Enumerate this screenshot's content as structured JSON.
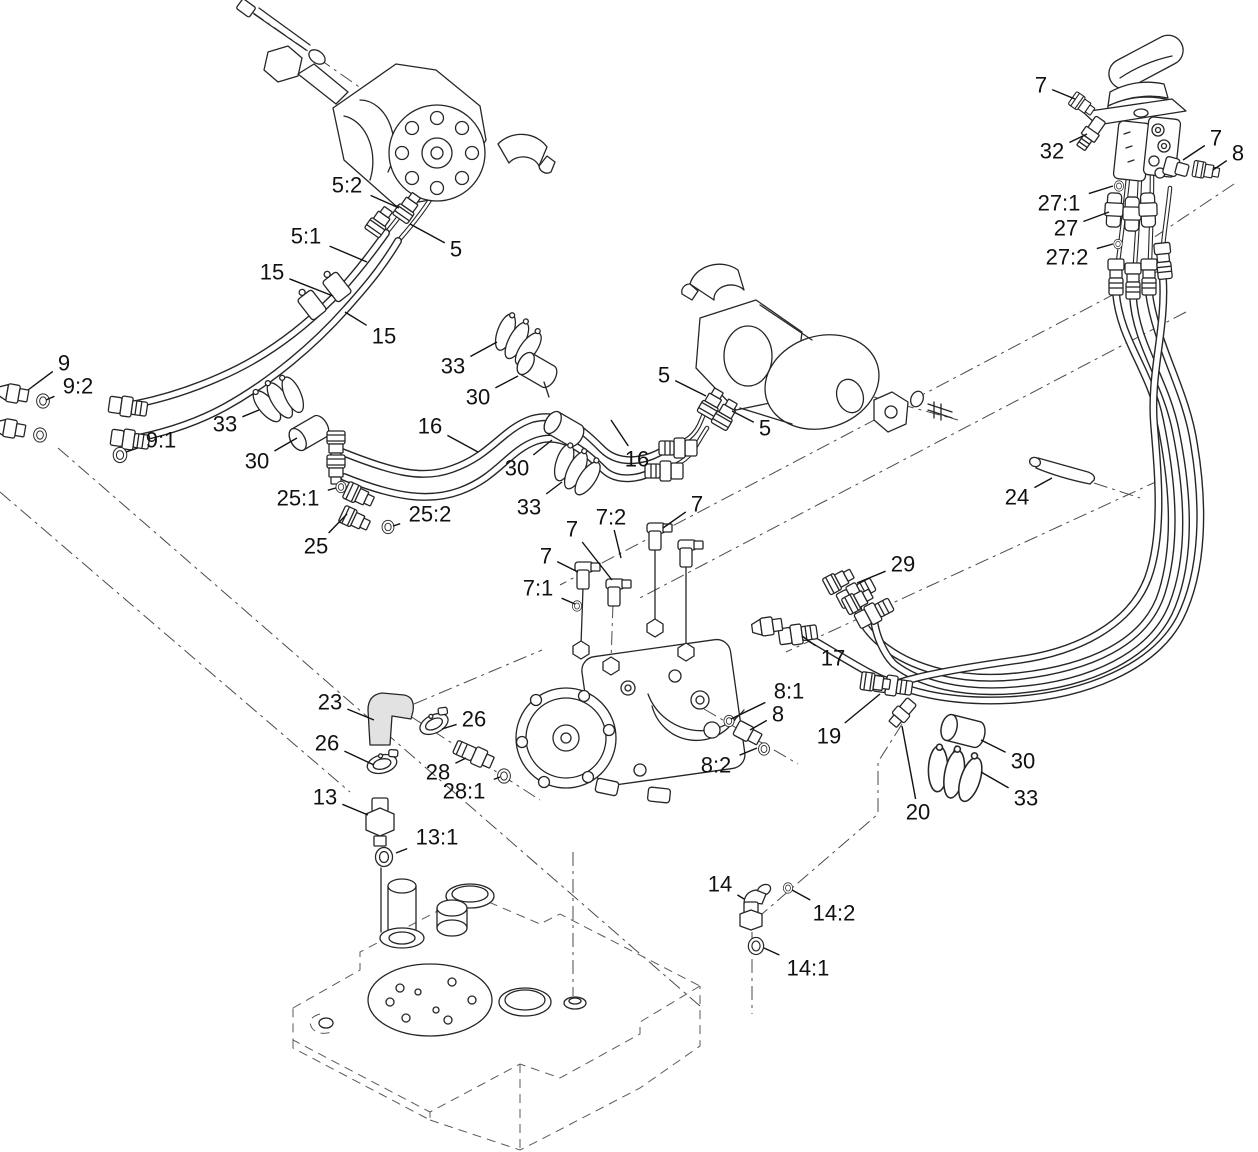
{
  "page": {
    "background": "#ffffff",
    "ink_color": "#262626",
    "phantom_line_color": "#4a4a4a",
    "label_color": "#111111"
  },
  "diagram": {
    "type": "exploded-parts-diagram",
    "canvas": {
      "width": 1258,
      "height": 1152
    },
    "callouts": [
      {
        "label": "5:2",
        "x": 347,
        "y": 185,
        "tx": 399,
        "ty": 208
      },
      {
        "label": "5:1",
        "x": 306,
        "y": 236,
        "tx": 367,
        "ty": 262
      },
      {
        "label": "5",
        "x": 456,
        "y": 249,
        "tx": 410,
        "ty": 224
      },
      {
        "label": "15",
        "x": 272,
        "y": 272,
        "tx": 333,
        "ty": 296
      },
      {
        "label": "15",
        "x": 384,
        "y": 336,
        "tx": 345,
        "ty": 312
      },
      {
        "label": "9",
        "x": 64,
        "y": 363,
        "tx": 28,
        "ty": 390
      },
      {
        "label": "9:2",
        "x": 78,
        "y": 386,
        "tx": 46,
        "ty": 400
      },
      {
        "label": "9:1",
        "x": 161,
        "y": 440,
        "tx": 126,
        "ty": 452
      },
      {
        "label": "33",
        "x": 225,
        "y": 424,
        "tx": 259,
        "ty": 410
      },
      {
        "label": "30",
        "x": 257,
        "y": 461,
        "tx": 297,
        "ty": 438
      },
      {
        "label": "25:1",
        "x": 298,
        "y": 498,
        "tx": 336,
        "ty": 488
      },
      {
        "label": "25",
        "x": 316,
        "y": 546,
        "tx": 347,
        "ty": 514
      },
      {
        "label": "25:2",
        "x": 430,
        "y": 514,
        "tx": 393,
        "ty": 526
      },
      {
        "label": "16",
        "x": 430,
        "y": 426,
        "tx": 478,
        "ty": 452
      },
      {
        "label": "33",
        "x": 453,
        "y": 366,
        "tx": 497,
        "ty": 342
      },
      {
        "label": "30",
        "x": 478,
        "y": 397,
        "tx": 518,
        "ty": 376
      },
      {
        "label": "30",
        "x": 517,
        "y": 468,
        "tx": 552,
        "ty": 440
      },
      {
        "label": "33",
        "x": 529,
        "y": 507,
        "tx": 562,
        "ty": 482
      },
      {
        "label": "16",
        "x": 637,
        "y": 459,
        "tx": 611,
        "ty": 420
      },
      {
        "label": "5",
        "x": 664,
        "y": 375,
        "tx": 706,
        "ty": 396
      },
      {
        "label": "5",
        "x": 765,
        "y": 428,
        "tx": 732,
        "ty": 411
      },
      {
        "label": "7",
        "x": 1041,
        "y": 85,
        "tx": 1075,
        "ty": 99
      },
      {
        "label": "32",
        "x": 1052,
        "y": 151,
        "tx": 1087,
        "ty": 134
      },
      {
        "label": "27:1",
        "x": 1059,
        "y": 203,
        "tx": 1113,
        "ty": 186
      },
      {
        "label": "27",
        "x": 1066,
        "y": 228,
        "tx": 1109,
        "ty": 212
      },
      {
        "label": "27:2",
        "x": 1067,
        "y": 257,
        "tx": 1113,
        "ty": 244
      },
      {
        "label": "7",
        "x": 1216,
        "y": 138,
        "tx": 1183,
        "ty": 160
      },
      {
        "label": "8",
        "x": 1238,
        "y": 153,
        "tx": 1213,
        "ty": 170
      },
      {
        "label": "24",
        "x": 1017,
        "y": 497,
        "tx": 1052,
        "ty": 478
      },
      {
        "label": "29",
        "x": 903,
        "y": 564,
        "tx": 857,
        "ty": 583
      },
      {
        "label": "17",
        "x": 833,
        "y": 658,
        "tx": 802,
        "ty": 636
      },
      {
        "label": "7:2",
        "x": 611,
        "y": 517,
        "tx": 621,
        "ty": 558
      },
      {
        "label": "7",
        "x": 697,
        "y": 504,
        "tx": 663,
        "ty": 528
      },
      {
        "label": "7",
        "x": 572,
        "y": 529,
        "tx": 612,
        "ty": 580
      },
      {
        "label": "7",
        "x": 546,
        "y": 556,
        "tx": 578,
        "ty": 572
      },
      {
        "label": "7:1",
        "x": 538,
        "y": 588,
        "tx": 575,
        "ty": 604
      },
      {
        "label": "8:1",
        "x": 789,
        "y": 691,
        "tx": 731,
        "ty": 719
      },
      {
        "label": "8",
        "x": 778,
        "y": 714,
        "tx": 750,
        "ty": 730
      },
      {
        "label": "8:2",
        "x": 716,
        "y": 765,
        "tx": 757,
        "ty": 748
      },
      {
        "label": "19",
        "x": 829,
        "y": 736,
        "tx": 880,
        "ty": 694
      },
      {
        "label": "20",
        "x": 918,
        "y": 812,
        "tx": 902,
        "ty": 726
      },
      {
        "label": "30",
        "x": 1023,
        "y": 761,
        "tx": 981,
        "ty": 740
      },
      {
        "label": "33",
        "x": 1026,
        "y": 798,
        "tx": 981,
        "ty": 772
      },
      {
        "label": "23",
        "x": 330,
        "y": 702,
        "tx": 374,
        "ty": 720
      },
      {
        "label": "26",
        "x": 474,
        "y": 719,
        "tx": 442,
        "ty": 729
      },
      {
        "label": "26",
        "x": 327,
        "y": 743,
        "tx": 374,
        "ty": 765
      },
      {
        "label": "28",
        "x": 438,
        "y": 772,
        "tx": 466,
        "ty": 758
      },
      {
        "label": "28:1",
        "x": 464,
        "y": 791,
        "tx": 500,
        "ty": 777
      },
      {
        "label": "13",
        "x": 325,
        "y": 797,
        "tx": 368,
        "ty": 815
      },
      {
        "label": "13:1",
        "x": 437,
        "y": 837,
        "tx": 396,
        "ty": 853
      },
      {
        "label": "14",
        "x": 720,
        "y": 884,
        "tx": 744,
        "ty": 899
      },
      {
        "label": "14:2",
        "x": 834,
        "y": 913,
        "tx": 792,
        "ty": 890
      },
      {
        "label": "14:1",
        "x": 808,
        "y": 968,
        "tx": 764,
        "ty": 948
      }
    ]
  }
}
